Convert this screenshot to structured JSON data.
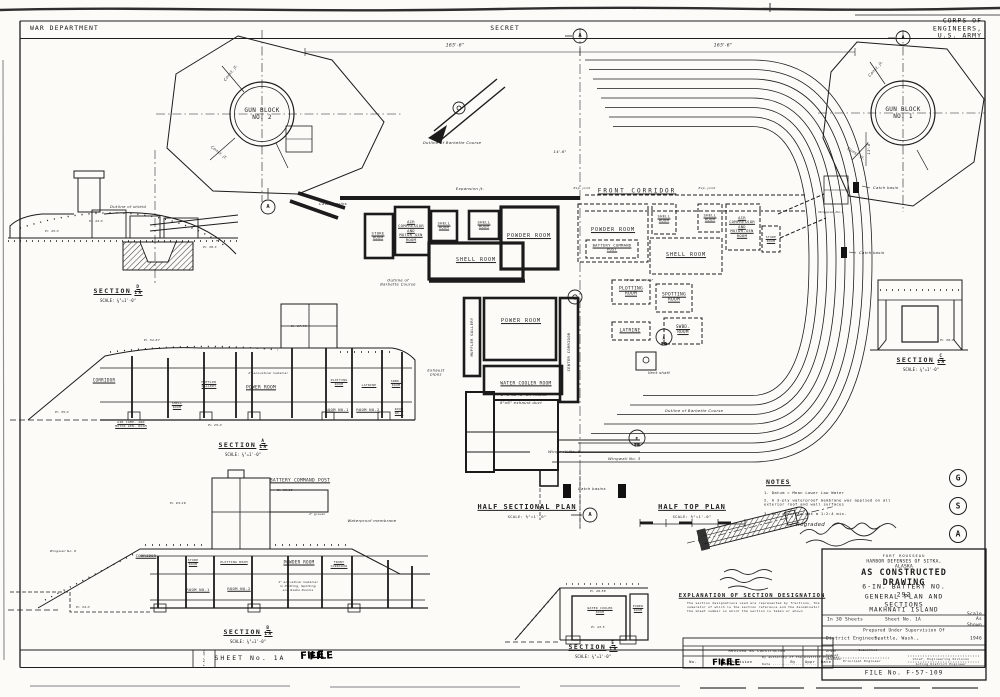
{
  "header": {
    "left": "WAR DEPARTMENT",
    "center": "SECRET",
    "right": "CORPS OF ENGINEERS, U.S. ARMY"
  },
  "gun_blocks": {
    "no2": "GUN BLOCK\nNO. 2",
    "no1": "GUN BLOCK\nNO. 1",
    "const_jt": "Const. jt.",
    "catch_basin": "Catch basin",
    "wingwall1": "Wingwall No.1",
    "dim_13_6": "13'-6\""
  },
  "dims": {
    "d165_left": "165'-6\"",
    "d165_right": "165'-6\"",
    "d14_6": "14'-6\""
  },
  "plan": {
    "front_corridor": "FRONT  CORRIDOR",
    "store_room": "STORE\nROOM",
    "air_comp": "AIR\nCOMPRESSOR\nAND\nMOTOR GEN\nROOM",
    "air_comp_r": "AIR\nCOMPRESSOR\nAND\nMOTOR-GEN\nROOM",
    "shell_room_2l": "SHELL\nROOM",
    "shell_room": "SHELL  ROOM",
    "powder_room": "POWDER  ROOM",
    "battery_command_post": "BATTERY COMMAND\nPOST",
    "plotting_room": "PLOTTING\nROOM",
    "spotting_room": "SPOTTING\nROOM",
    "latrine": "LATRINE",
    "swbd_room": "SWBD.\nROOM",
    "power_room": "POWER ROOM",
    "muffler_gallery": "MUFFLER  GALLERY",
    "center_corridor": "CENTER  CORRIDOR",
    "water_cooler_room": "WATER COOLER ROOM",
    "air_intake": "2'-0\"x2'-6\" air intake",
    "exhaust_duct": "6\"x6\" exhaust duct",
    "vent_shaft": "Vent shaft",
    "exhaust_pipes": "Exhaust\npipes",
    "catch_basins": "Catch basins",
    "expansion_jt": "Expansion jt.",
    "exp_joint": "Exp. joint",
    "exp_jt_roof": "Exp. jt. in roof",
    "outline_barbette_1l": "Outline of Barbette Course",
    "outline_barbette_2l": "Outline of\nBarbette Course",
    "wingwall5": "Wingwall No. 5",
    "wingwall3": "Wingwall No. 3"
  },
  "plans": {
    "half_sectional": "HALF SECTIONAL PLAN",
    "half_top": "HALF TOP PLAN",
    "scale": "SCALE: ⅛\"=1'-0\""
  },
  "sections": {
    "title": "SECTION",
    "scale": "SCALE: ⅛\"=1'-0\"",
    "den": "1A",
    "d_num": "D",
    "a_num": "A",
    "b_num": "B",
    "c_num": "C",
    "e_num": "E"
  },
  "section_d": {
    "outline_shield": "Outline of shield"
  },
  "section_a": {
    "corridor": "CORRIDOR",
    "shell_room": "SHELL\nROOM",
    "air_comp": "AIR COMP. AND\nMOTOR GEN. ROOM",
    "muffler": "MUFFLER\nGALLERY",
    "power_room": "POWER  ROOM",
    "acoustical": "2\" acoustical material",
    "plotting": "PLOTTING\nROOM",
    "latrine": "LATRINE",
    "swbd": "SWBD.\nROOM",
    "room1": "ROOM NO.1",
    "room2": "ROOM NO.2",
    "room3": "ROOM\nNO.3"
  },
  "section_b": {
    "bc_post": "BATTERY  COMMAND  POST",
    "corridor": "CORRIDOR",
    "store": "STORE\nROOM",
    "plotting": "PLOTTING ROOM",
    "powder": "POWDER  ROOM",
    "front_corridor": "FRONT\nCORRIDOR",
    "room1": "ROOM NO.1",
    "room2": "ROOM NO.2",
    "acoustical": "1\" acoustical material\nin Plotting, Spotting\nand Radio Rooms",
    "membrane": "Waterproof membrane",
    "gravel": "4\" gravel",
    "wingwall6": "Wingwall No. 6"
  },
  "section_e": {
    "water_cooler": "WATER COOLER\nROOM",
    "power": "POWER\nROOM"
  },
  "elevations": [
    "El. 45.0",
    "El. 43.0",
    "El. 39.3",
    "El. 52.67",
    "El. 35.0",
    "El. 25.0",
    "El. 67.79",
    "El. 69.89",
    "El. 63.29",
    "El. 34.0",
    "El. 38.0",
    "El. 49.58",
    "El. 43.5"
  ],
  "notes": {
    "title": "NOTES",
    "item1": "1.  Datum = Mean Lower Low Water",
    "item2": "2.  A 3-ply waterproof membrane was applied on all\n      exterior roof and wall surfaces",
    "item3": "3.  All concrete was a 1:2:4 mix.",
    "regraded": "Regraded"
  },
  "explanation": {
    "title": "EXPLANATION OF SECTION DESIGNATION",
    "body": "The section designations used are represented by fractions, the numerator of which is the section reference and the denominator the sheet number on which the section is taken or shown"
  },
  "revision": {
    "revised": "Revised  as  constructed",
    "no": "No.",
    "revision": "Revision",
    "by": "By",
    "appr": "Appr",
    "date": "Date"
  },
  "title_block": {
    "fort": "FORT  ROUSSEAU",
    "harbor": "HARBOR  DEFENSES  OF  SITKA,   ALASKA",
    "title1": "AS  CONSTRUCTED  DRAWING",
    "title2": "6-IN.  BATTERY  NO.  292",
    "title3": "GENERAL  PLAN  AND  SECTIONS",
    "title4": "MAKHNATI  ISLAND",
    "sheets": "In 30 Sheets",
    "sheet_no": "Sheet No. 1A",
    "scale": "Scale  As  Shown",
    "prepared": "Prepared Under Supervision Of",
    "engineer": "District Engineer,",
    "city": "Seattle, Wash.,",
    "year": "1946",
    "crew": "Drawn\nTraced\nChecked",
    "submitted": "Submitted",
    "principal": "Principal Engineer",
    "chief": "Chief, Engineering Division",
    "acting": "Acting District Engineer",
    "file": "FILE  No.  F-57-109"
  },
  "bottom": {
    "sheet": "SHEET  No. 1A",
    "stamp": "FILE",
    "authority": "By  authority  of  the  District  Engineer",
    "date_line": "Date .....................",
    "vert_file": "F-57-109"
  },
  "markers": {
    "a": "A",
    "e": "E",
    "g": "G",
    "s": "S",
    "den": "1A"
  }
}
